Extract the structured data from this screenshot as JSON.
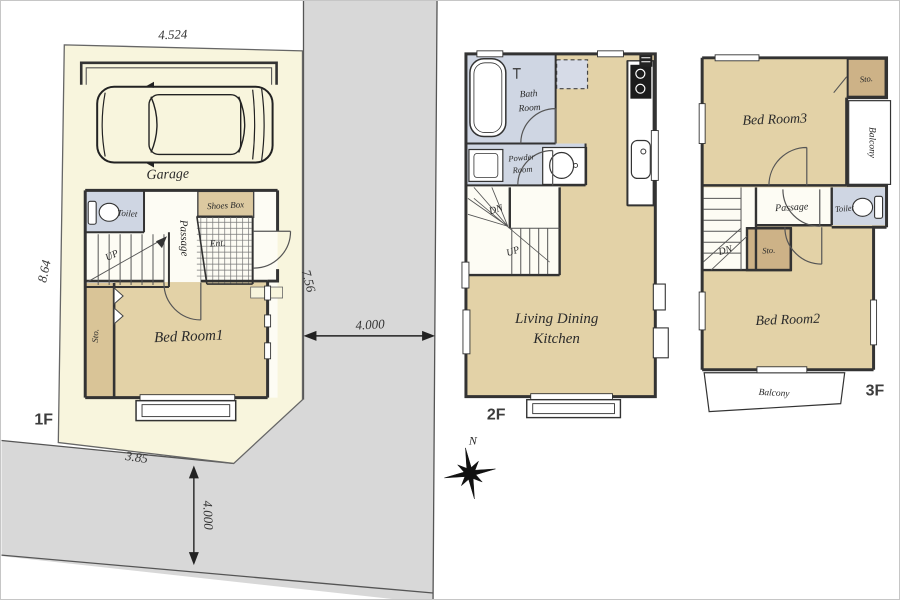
{
  "palette": {
    "road_gray": "#d8d8d8",
    "site_cream": "#f8f5dd",
    "room_tan": "#e3d2a7",
    "wet_blue": "#cfd6e3",
    "storage_tan": "#cdb287",
    "wall_dark": "#333333",
    "line_gray": "#7a7a7a"
  },
  "site_1f": {
    "floor_label": "1F",
    "dimensions": {
      "top_width": "4.524",
      "left_depth": "8.64",
      "right_depth": "7.56",
      "bottom_width": "3.85",
      "road_right_width": "4.000",
      "road_bottom_width": "4.000"
    },
    "labels": {
      "garage": "Garage",
      "toilet": "Toilet",
      "shoes_box": "Shoes Box",
      "entrance": "Ent.",
      "passage": "Passage",
      "stairs_up": "UP",
      "bedroom1": "Bed Room1",
      "storage": "Sto."
    }
  },
  "floor_2f": {
    "floor_label": "2F",
    "labels": {
      "bath_room_line1": "Bath",
      "bath_room_line2": "Room",
      "powder_room_line1": "Powder",
      "powder_room_line2": "Room",
      "stairs_down": "DN",
      "stairs_up": "UP",
      "ldk_line1": "Living Dining",
      "ldk_line2": "Kitchen"
    }
  },
  "floor_3f": {
    "floor_label": "3F",
    "labels": {
      "bedroom3": "Bed Room3",
      "storage_top": "Sto.",
      "balcony_right": "Balcony",
      "passage": "Passage",
      "toilet": "Toilet",
      "stairs_down": "DN",
      "storage_mid": "Sto.",
      "bedroom2": "Bed Room2",
      "balcony_bottom": "Balcony"
    }
  },
  "compass": {
    "north": "N"
  }
}
